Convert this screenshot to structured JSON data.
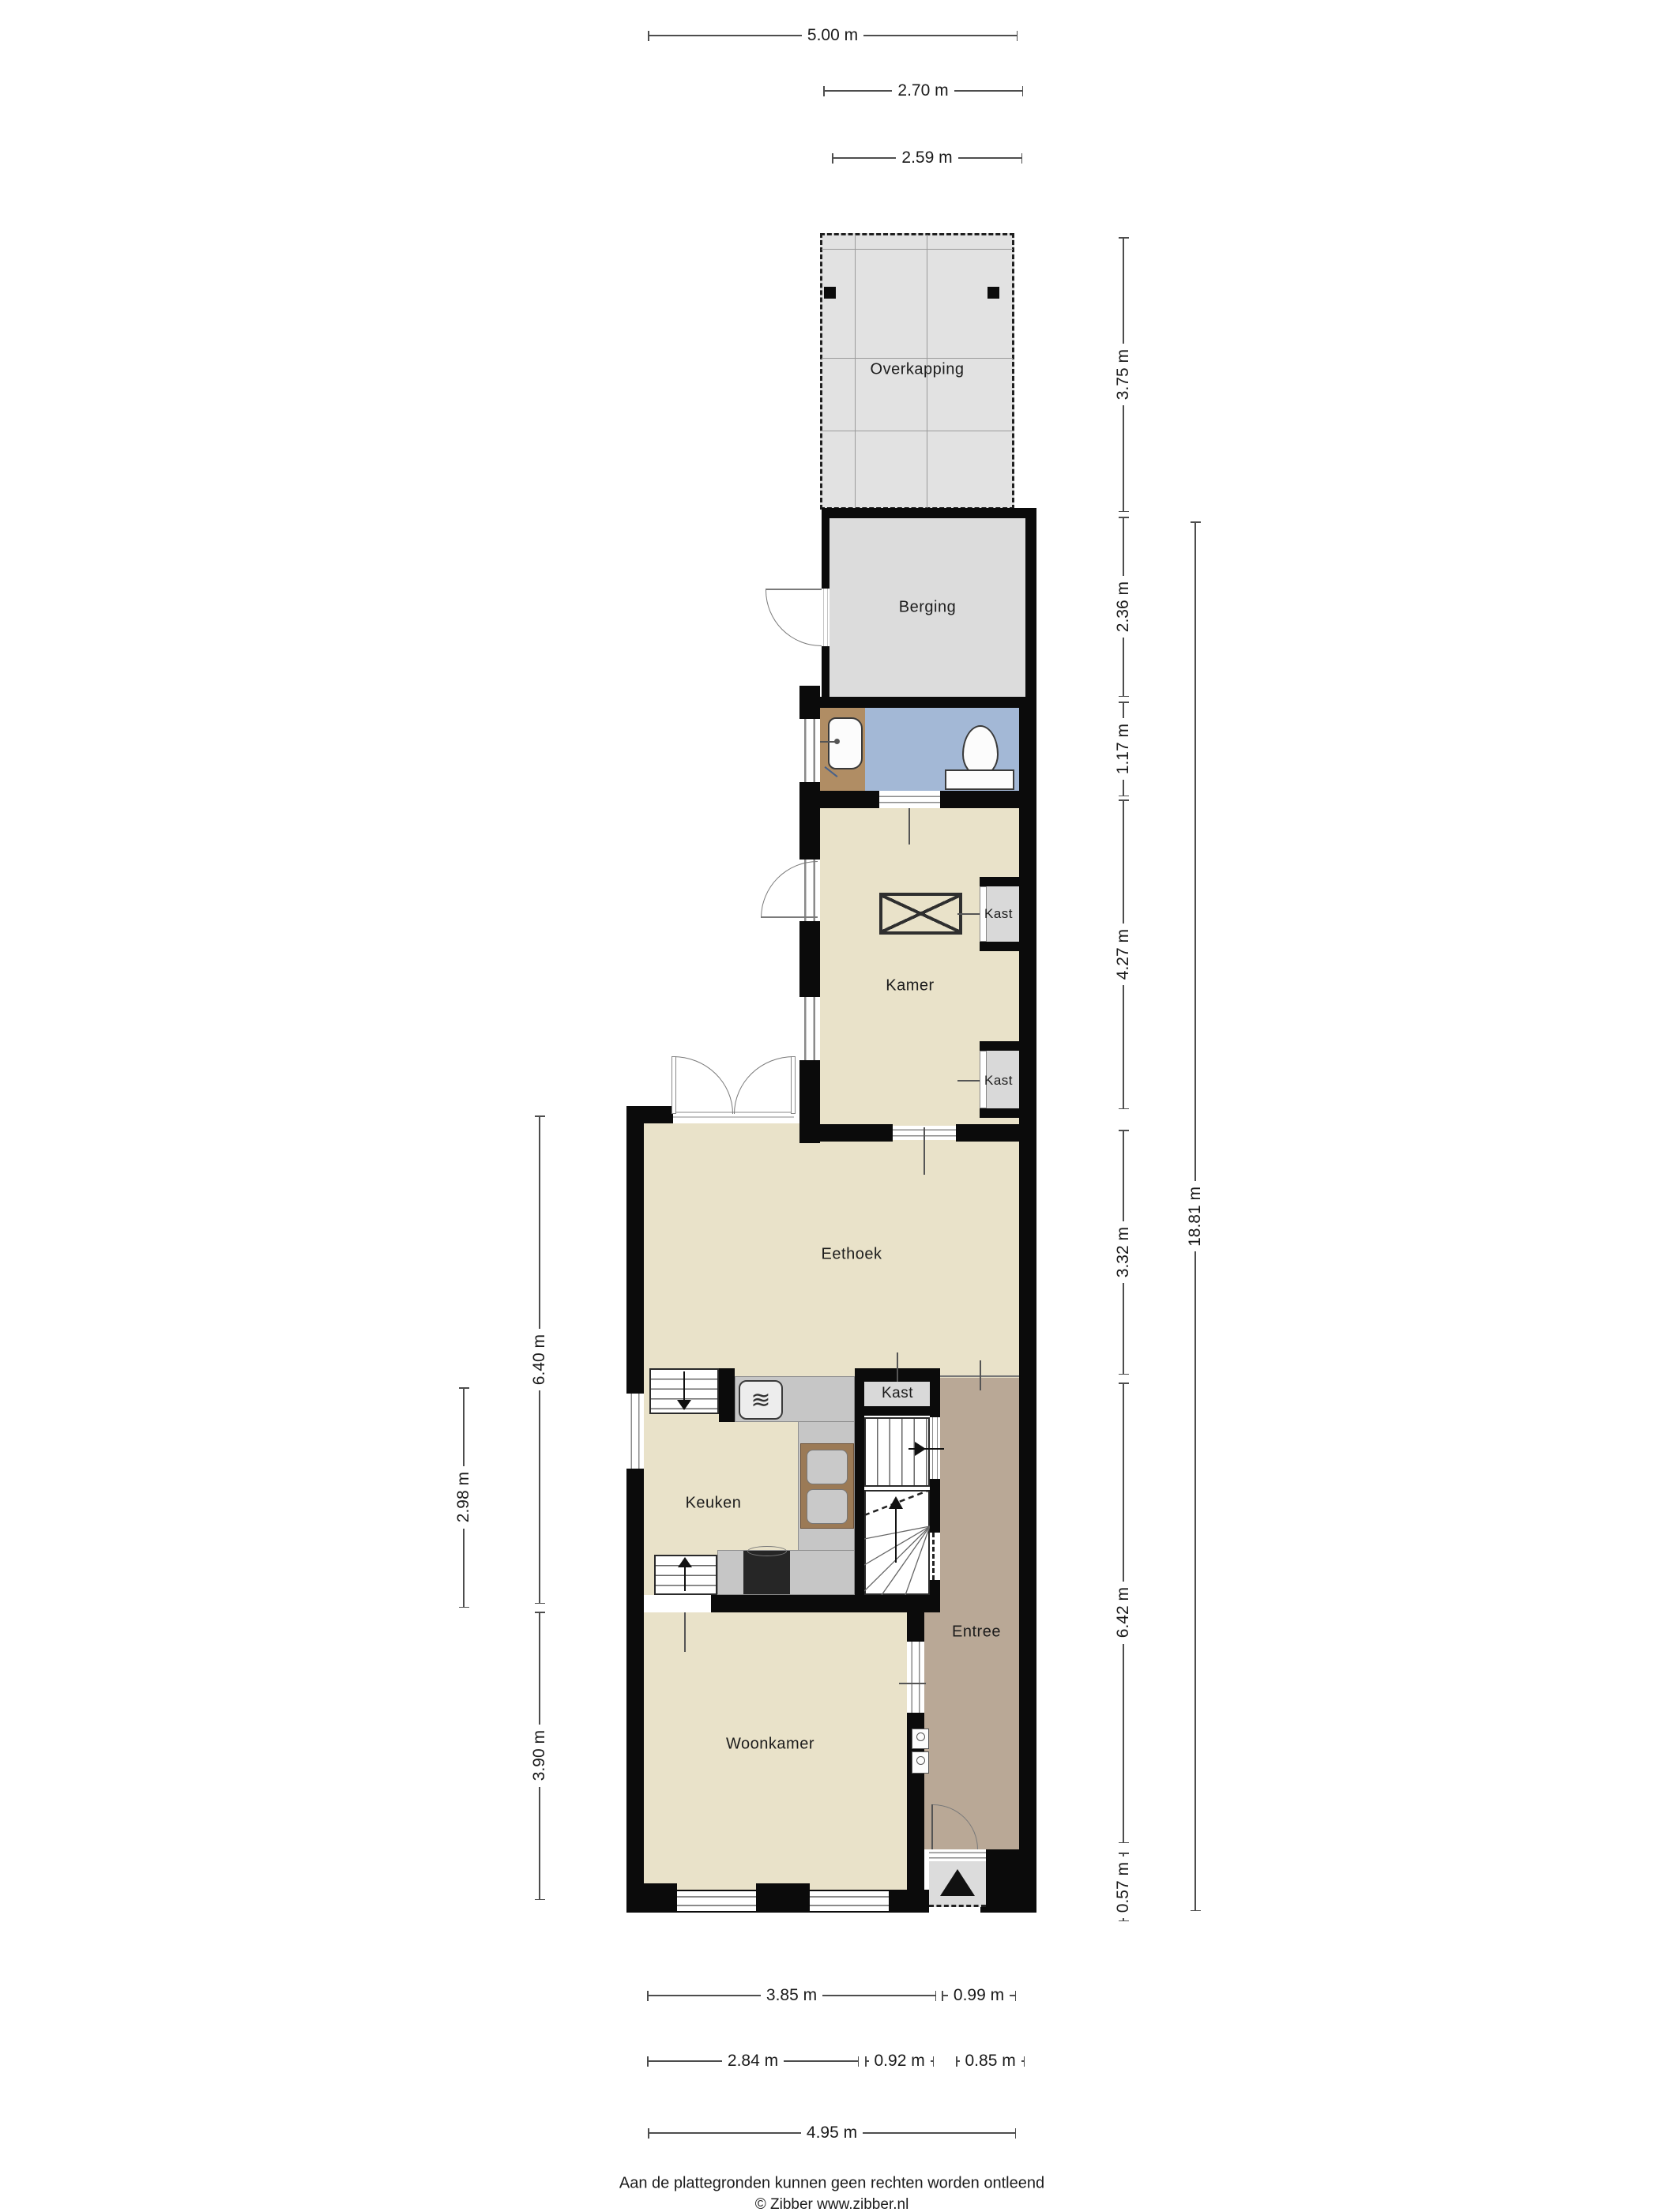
{
  "rooms": {
    "overkapping": "Overkapping",
    "berging": "Berging",
    "kamer": "Kamer",
    "eethoek": "Eethoek",
    "keuken": "Keuken",
    "entree": "Entree",
    "woonkamer": "Woonkamer"
  },
  "closets": [
    "Kast",
    "Kast",
    "Kast"
  ],
  "dims": {
    "top": [
      "5.00 m",
      "2.70 m",
      "2.59 m"
    ],
    "right": [
      "3.75 m",
      "2.36 m",
      "1.17 m",
      "4.27 m",
      "3.32 m",
      "6.42 m",
      "0.57 m",
      "18.81 m"
    ],
    "left": [
      "6.40 m",
      "2.98 m",
      "3.90 m"
    ],
    "bottom": [
      "3.85 m",
      "0.99 m",
      "2.84 m",
      "0.92 m",
      "0.85 m",
      "4.95 m"
    ]
  },
  "footer": {
    "line1": "Aan de plattegronden kunnen geen rechten worden ontleend",
    "line2": "© Zibber www.zibber.nl"
  },
  "icons": {
    "microwave": "≋"
  },
  "colors": {
    "wall": "#0b0b0b",
    "beige": "#e9e2c9",
    "gray": "#dcdcdc",
    "overkapping": "#e2e2e2",
    "blue": "#a3b8d6",
    "wood": "#b08d64",
    "taupe": "#b9a896",
    "counter": "#c6c6c6",
    "kast": "#d9d9d9",
    "sinkwood": "#9b7a56",
    "stove": "#262626"
  }
}
